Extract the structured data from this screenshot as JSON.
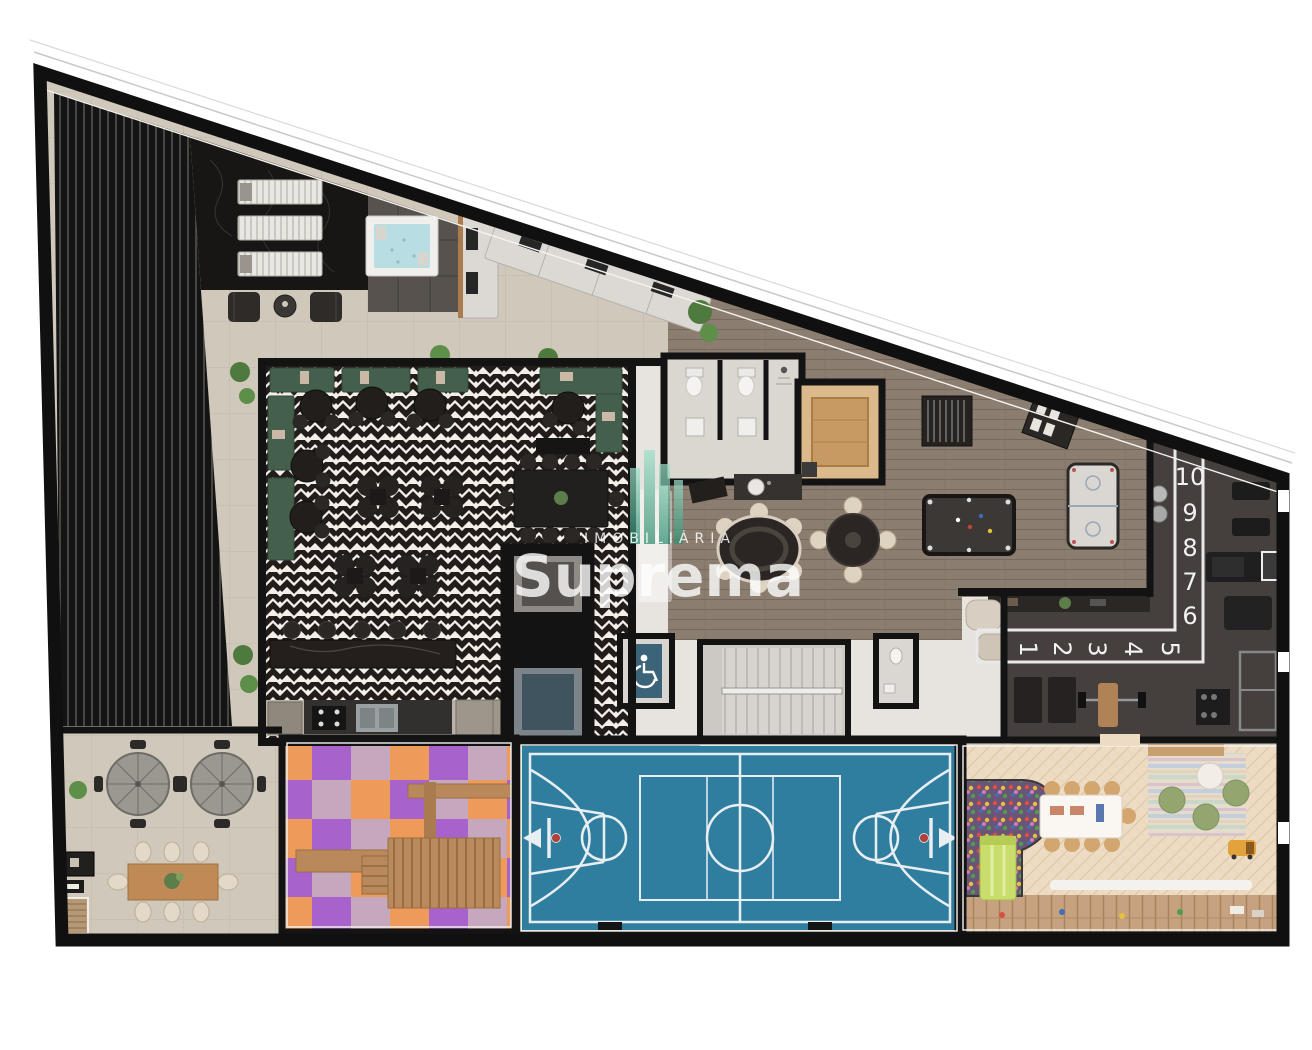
{
  "watermark": {
    "tagline": "IMOBILIÁRIA",
    "brand": "Suprema"
  },
  "gym_track": {
    "vertical_markers": [
      "10",
      "9",
      "8",
      "7",
      "6"
    ],
    "horizontal_markers": [
      "1",
      "2",
      "3",
      "4",
      "5"
    ]
  },
  "palette": {
    "wall": "#131313",
    "terrace_stone": "#cfc8bb",
    "party_floor_dark": "#221d1a",
    "banquette_green": "#44604d",
    "games_wood": "#8b7e71",
    "gym_floor": "#45403d",
    "court_blue": "#2f7ea0",
    "court_line": "#e8eef2",
    "playground_orange": "#ee9a5a",
    "playground_purple": "#a763cb",
    "playground_mauve": "#c5a8bd",
    "kids_floor": "#eddcc3",
    "sauna_wood": "#dcb98b",
    "hot_tub_water": "#b8dde2",
    "watermark_white": "#ffffff",
    "logo_green": "#3fa488"
  }
}
